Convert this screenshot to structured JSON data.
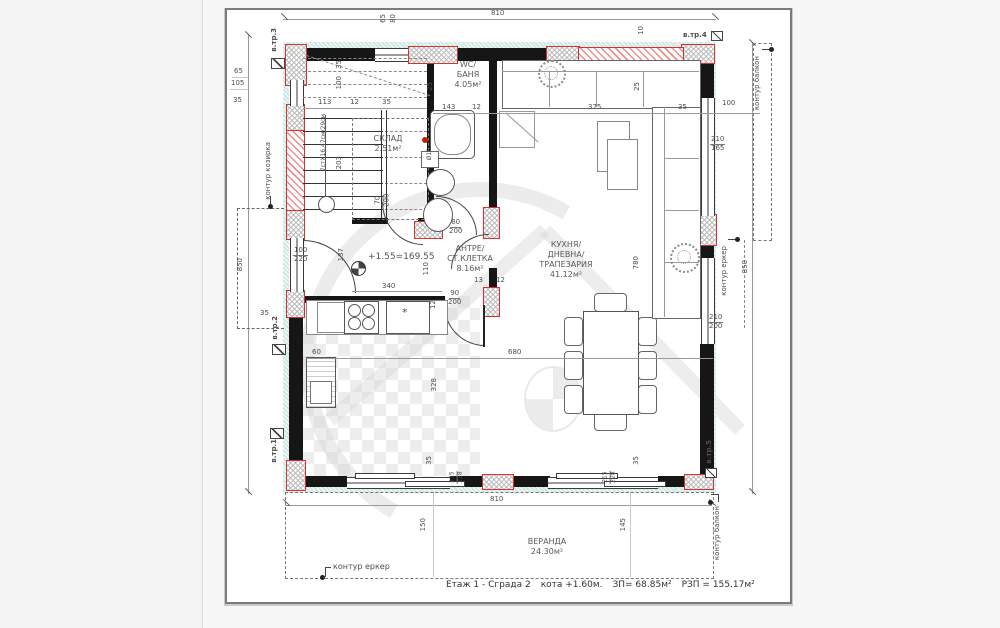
{
  "sheet": {
    "caption_floor": "Етаж 1 - Сграда 2",
    "caption_level": "кота +1.60м.",
    "caption_zp": "ЗП= 68.85м²",
    "caption_rzp": "РЗП = 155.17м²"
  },
  "rooms": {
    "wc": {
      "l1": "WC/",
      "l2": "БАНЯ",
      "area": "4.05м²"
    },
    "sklad": {
      "l1": "СКЛАД",
      "area": "2.51м²"
    },
    "antre": {
      "l1": "АНТРЕ/",
      "l2": "СТ.КЛЕТКА",
      "area": "8.16м²"
    },
    "kitchen": {
      "l1": "КУХНЯ/",
      "l2": "ДНЕВНА/",
      "l3": "ТРАПЕЗАРИЯ",
      "area": "41.12м²"
    },
    "veranda": {
      "l1": "ВЕРАНДА",
      "area": "24.30м²"
    }
  },
  "markers": {
    "m1": "в.тр.1",
    "m2": "в.тр.2",
    "m3": "в.тр.3",
    "m4": "в.тр.4",
    "m5": "в.тр.5"
  },
  "contours": {
    "kozirka": "контур козирка",
    "balkon_top": "контур балкон",
    "balkon_bottom": "контур балкон",
    "erker_right": "контур еркер",
    "erker_bottom": "контур еркер"
  },
  "level_mark": "+1.55=169.55",
  "stairs_note": "7стX16.47см/29см",
  "star_mark": "*",
  "dims": {
    "top_810": "810",
    "bottom_810": "810",
    "left_850": "850",
    "right_850": "850",
    "v150": "150",
    "v145": "145",
    "d143": "143",
    "d12a": "12",
    "d375": "375",
    "d35a": "35",
    "d100a": "100",
    "d210a": "210",
    "d165": "165",
    "d210b": "210",
    "d200a": "200",
    "d25a": "25",
    "d25b": "25",
    "d10": "10",
    "d65t": "65",
    "d80t": "80",
    "d65l": "65",
    "d105l": "105",
    "d35l": "35",
    "d113": "113",
    "d12b": "12",
    "d35b": "35",
    "d35s": "35",
    "d100s": "100",
    "d203": "203",
    "w100": "100",
    "w220": "220",
    "d137": "137",
    "d340": "340",
    "d680": "680",
    "d60": "60",
    "d328": "328",
    "d780": "780",
    "d110": "110",
    "dr80": "80",
    "dr200": "200",
    "dr90": "90",
    "dr200b": "200",
    "d13": "13",
    "d12c": "12",
    "d12d": "12",
    "dd70": "70",
    "dd200": "200",
    "o18": "Ø18",
    "d215a": "215",
    "d228a": "228",
    "d215b": "215",
    "d228b": "228",
    "d35c": "35",
    "d35d": "35",
    "m2_35": "35"
  }
}
